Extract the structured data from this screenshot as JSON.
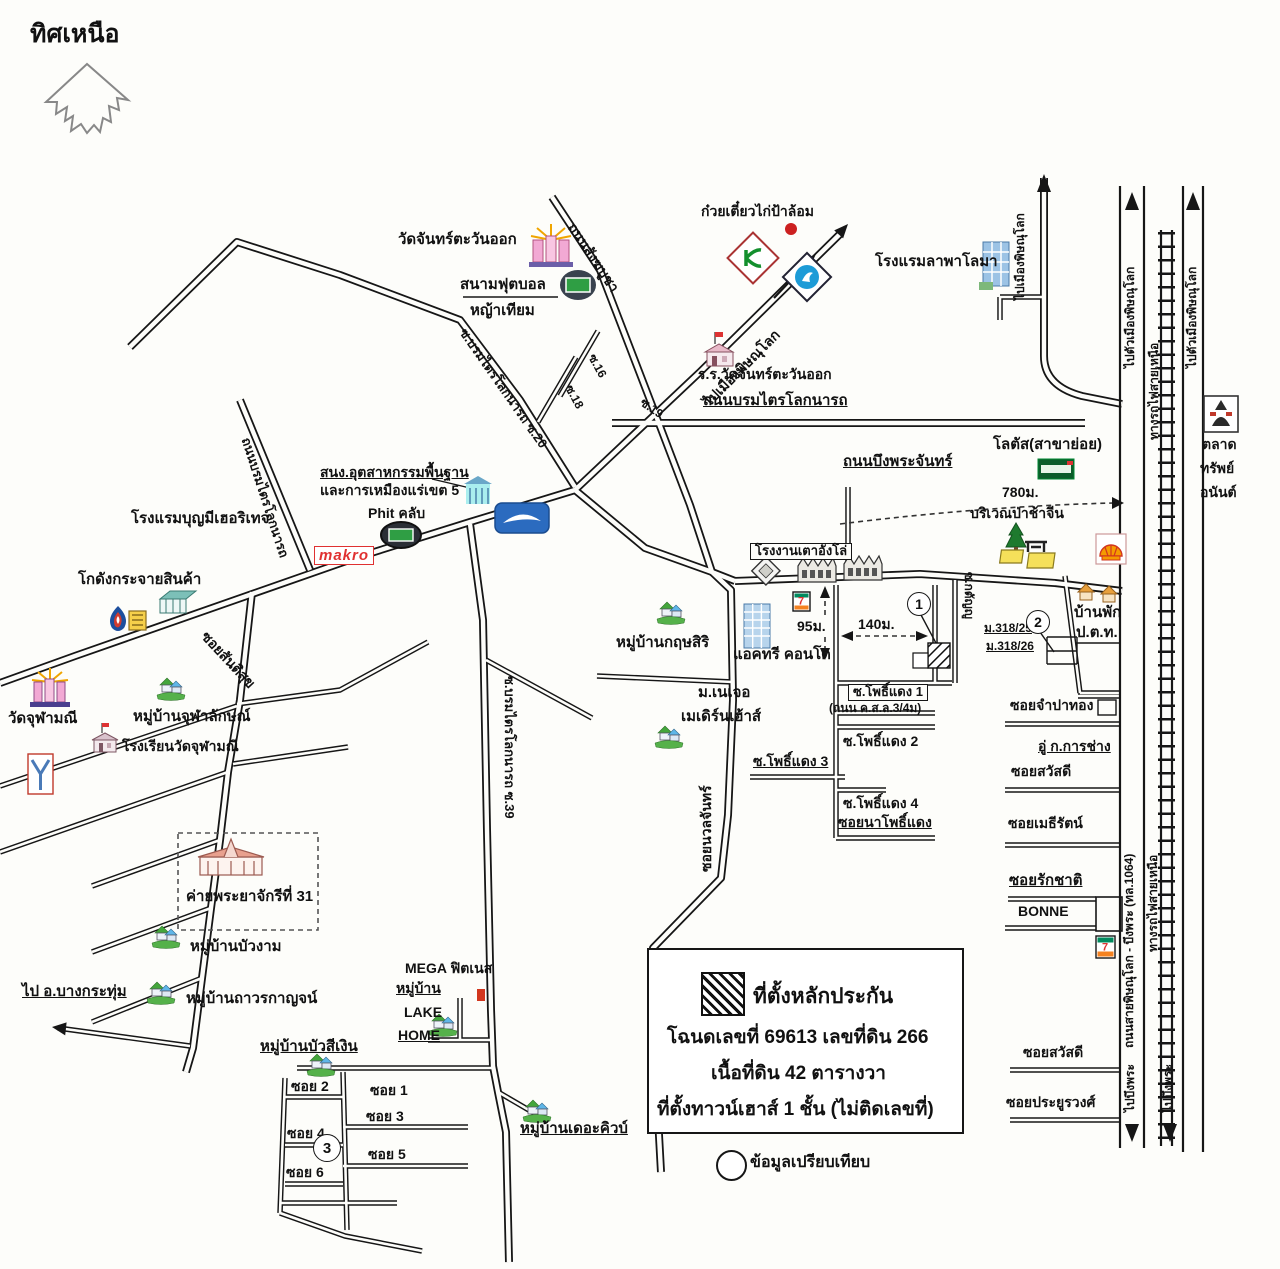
{
  "compass": {
    "north": "ทิศเหนือ"
  },
  "places": {
    "wat_chan_tawan_ok": "วัดจันทร์ตะวันออก",
    "football_field": "สนามฟุตบอล",
    "artificial_grass": "หญ้าเทียม",
    "noodle_shop": "ก๋วยเตี๋ยวไก่ป้าล้อม",
    "school_wat_chan": "ร.ร.วัดจันทร์ตะวันออก",
    "hotel_la_paloma": "โรงแรมลาพาโลมา",
    "market_line1": "ตลาด",
    "market_line2": "ทรัพย์",
    "market_line3": "อนันต์",
    "lotus_branch": "โลตัส(สาขาย่อย)",
    "cemetery_area": "บริเวณป่าช้าจีน",
    "mining_office_line1": "สนง.อุตสาหกรรมพื้นฐาน",
    "mining_office_line2": "และการเหมืองแร่เขต 5",
    "phit_club": "Phit คลับ",
    "makro": "makro",
    "hotel_boonme": "โรงแรมบุญมีเฮอริเทจ",
    "warehouse": "โกดังกระจายสินค้า",
    "wat_chulamani": "วัดจุฬามณี",
    "village_chulalak": "หมู่บ้านจุฬาลักษณ์",
    "school_wat_chulamani": "โรงเรียนวัดจุฬามณี",
    "camp_31": "ค่ายพระยาจักรีที่ 31",
    "village_buangam": "หมู่บ้านบัวงาม",
    "village_thawornkan": "หมู่บ้านถาวรกาญจน์",
    "mega_fitness": "MEGA ฟิตเนส",
    "village_word": "หมู่บ้าน",
    "lake": "LAKE",
    "home": "HOME",
    "village_buasingoen": "หมู่บ้านบัวสีเงิน",
    "village_thecube": "หมู่บ้านเดอะคิวบ์",
    "village_krissiri": "หมู่บ้านกฤษสิริ",
    "actree_condo": "แอคทรี คอนโด",
    "nature_line1": "ม.เนเจอ",
    "nature_line2": "เมเดิร์นเฮ้าส์",
    "stove_factory": "โรงงานเตาอังโล่",
    "ptt_house_line1": "บ้านพัก",
    "ptt_house_line2": "ป.ต.ท.",
    "garage": "อู่ ก.การช่าง",
    "bonne": "BONNE",
    "m318_25": "ม.318/25",
    "m318_26": "ม.318/26"
  },
  "roads": {
    "sangkhabucha": "ถนนสังฆบูชา",
    "to_phitsanulok": "ไปเมืองพิษณุโลก",
    "borommatrailok": "ถนนบรมไตรโลกนารถ",
    "soi16": "ซ.16",
    "soi18": "ซ.18",
    "soi19": "ซ.19",
    "borom_soi20": "ซ.บรมไตรโลกนารถ ซ.20",
    "borom_soi39": "ซ.บรมไตรโลกนารถ ซ.39",
    "santisuk": "ซอยสันติสุข",
    "buengphrachan": "ถนนบึงพระจันทร์",
    "to_city": "ไปตัวเมืองพิษณุโลก",
    "railway": "ทางรถไฟสายเหนือ",
    "nuanchan": "ซอยนวลจันทร์",
    "katanyu": "ซ.กตัญญู",
    "pho_daeng1": "ซ.โพธิ์แดง 1",
    "pho_daeng1_note": "(ถนน ค.ส.ล.3/4ม)",
    "pho_daeng2": "ซ.โพธิ์แดง 2",
    "pho_daeng3": "ซ.โพธิ์แดง 3",
    "pho_daeng4": "ซ.โพธิ์แดง 4",
    "na_pho_daeng": "ซอยนาโพธิ์แดง",
    "champathong": "ซอยจำปาทอง",
    "sawasdee": "ซอยสวัสดี",
    "mayrat": "ซอยเมธีรัตน์",
    "rakchat": "ซอยรักชาติ",
    "prayoonwong": "ซอยประยูรวงศ์",
    "route_1064": "ถนนสายพิษณุโลก - บึงพระ (ทล.1064)",
    "to_buengphra": "ไปบึงพระ",
    "to_bangkrathum": "ไป อ.บางกระทุ่ม",
    "soi_b": [
      "ซอย 1",
      "ซอย 2",
      "ซอย 3",
      "ซอย 4",
      "ซอย 5",
      "ซอย 6"
    ]
  },
  "distances": {
    "d780": "780ม.",
    "d95": "95ม.",
    "d140": "140ม."
  },
  "markers": {
    "m1": "1",
    "m2": "2",
    "m3": "3"
  },
  "legend": {
    "title": "ที่ตั้งหลักประกัน",
    "line1": "โฉนดเลขที่ 69613 เลขที่ดิน 266",
    "line2": "เนื้อที่ดิน 42 ตารางวา",
    "line3": "ที่ตั้งทาวน์เฮาส์ 1 ชั้น  (ไม่ติดเลขที่)"
  },
  "note": {
    "compare": "ข้อมูลเปรียบเทียบ"
  },
  "icons": {
    "seven_glyph": "7"
  },
  "colors": {
    "road": "#161616",
    "makro_red": "#e03131",
    "lotus_green": "#0b5c2a",
    "shell_orange": "#f59b00",
    "house_green": "#44a63c",
    "kasikorn_green": "#138f2d",
    "ktb_blue": "#1d9bd7",
    "seven_orange": "#f58220",
    "building_blue": "#9cc3e5"
  }
}
